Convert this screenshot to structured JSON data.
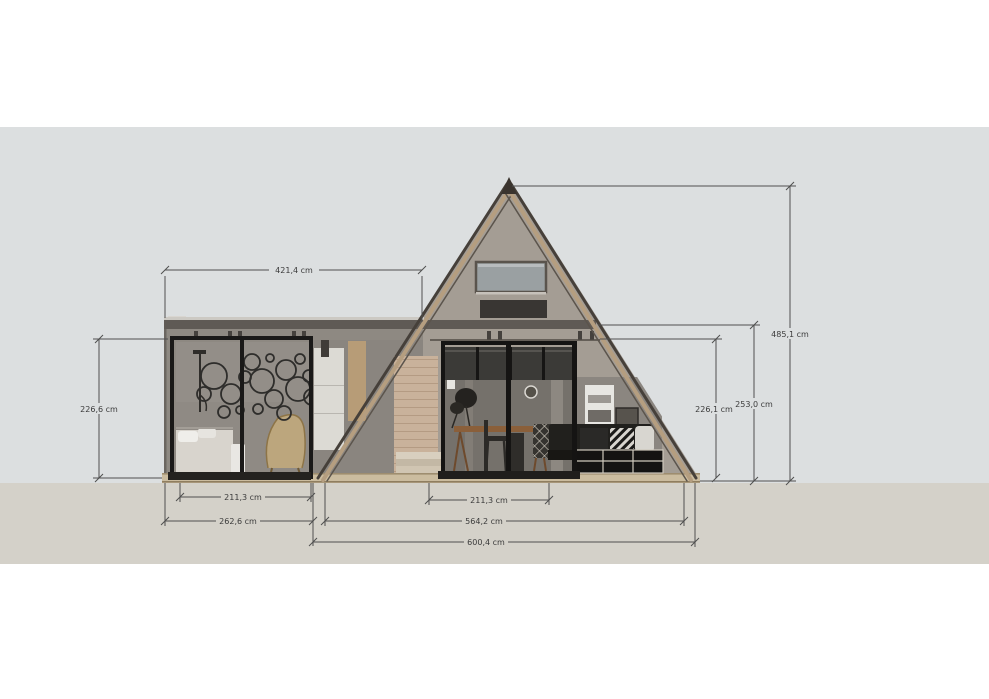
{
  "drawing": {
    "type": "A-frame cabin front elevation",
    "unit": "cm",
    "dimensions": {
      "top_width": "421,4 cm",
      "left_door_height": "226,6 cm",
      "right_door_height": "226,1 cm",
      "side_wall_height": "253,0 cm",
      "apex_height": "485,1 cm",
      "left_door_width": "211,3 cm",
      "front_door_width": "211,3 cm",
      "left_block_width": "262,6 cm",
      "front_width": "564,2 cm",
      "base_width": "600,4 cm"
    },
    "colors": {
      "background": "#ffffff",
      "sky": "#dcdfe0",
      "ground": "#d4d1c9",
      "gable_wall": "#a49d94",
      "flat_wall": "#8e8982",
      "roof_edge": "#46403a",
      "fascia": "#b59e80",
      "dimension_line": "#4f4f4f"
    }
  }
}
